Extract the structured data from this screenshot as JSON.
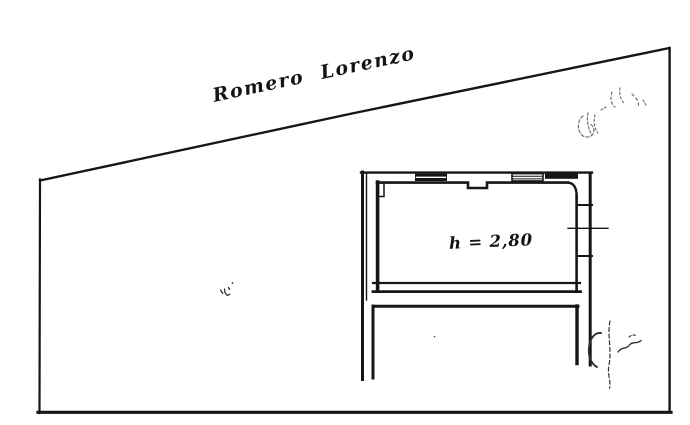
{
  "page": {
    "background_color": "#ffffff",
    "ink_color": "#161616",
    "pencil_color": "#2e2e2e"
  },
  "plan": {
    "owner_label": "Romero Lorenzo",
    "room_height_label": "h = 2,80",
    "marks": [
      "faint-pencil-scribble-top-right",
      "signature-scribble-right",
      "small-ink-mark-center-left"
    ]
  }
}
